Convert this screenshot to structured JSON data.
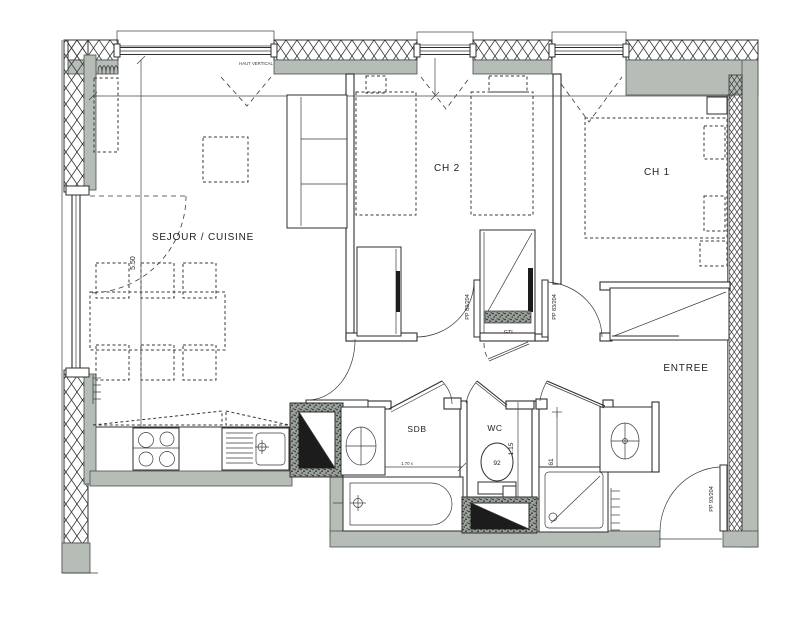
{
  "plan": {
    "rooms": {
      "sejour": "SEJOUR / CUISINE",
      "ch2": "CH 2",
      "ch1": "CH 1",
      "entree": "ENTREE",
      "sdb": "SDB",
      "wc": "WC"
    },
    "labels": {
      "gtl": "GTL",
      "shutter": "HAUT VERTICAL"
    },
    "doors": {
      "ch2": "PP 83/204",
      "ch1": "PP 83/204",
      "entry": "PP 93/204"
    },
    "dims": {
      "sejour_depth": "5.50",
      "wc_width": "1.15",
      "toilet_clearance": "92",
      "shower_width": "61",
      "bathtub": "1.70 x"
    },
    "colors": {
      "wall_fill": "#b6bdb6",
      "line": "#2e2e2e",
      "paper": "#ffffff"
    }
  }
}
